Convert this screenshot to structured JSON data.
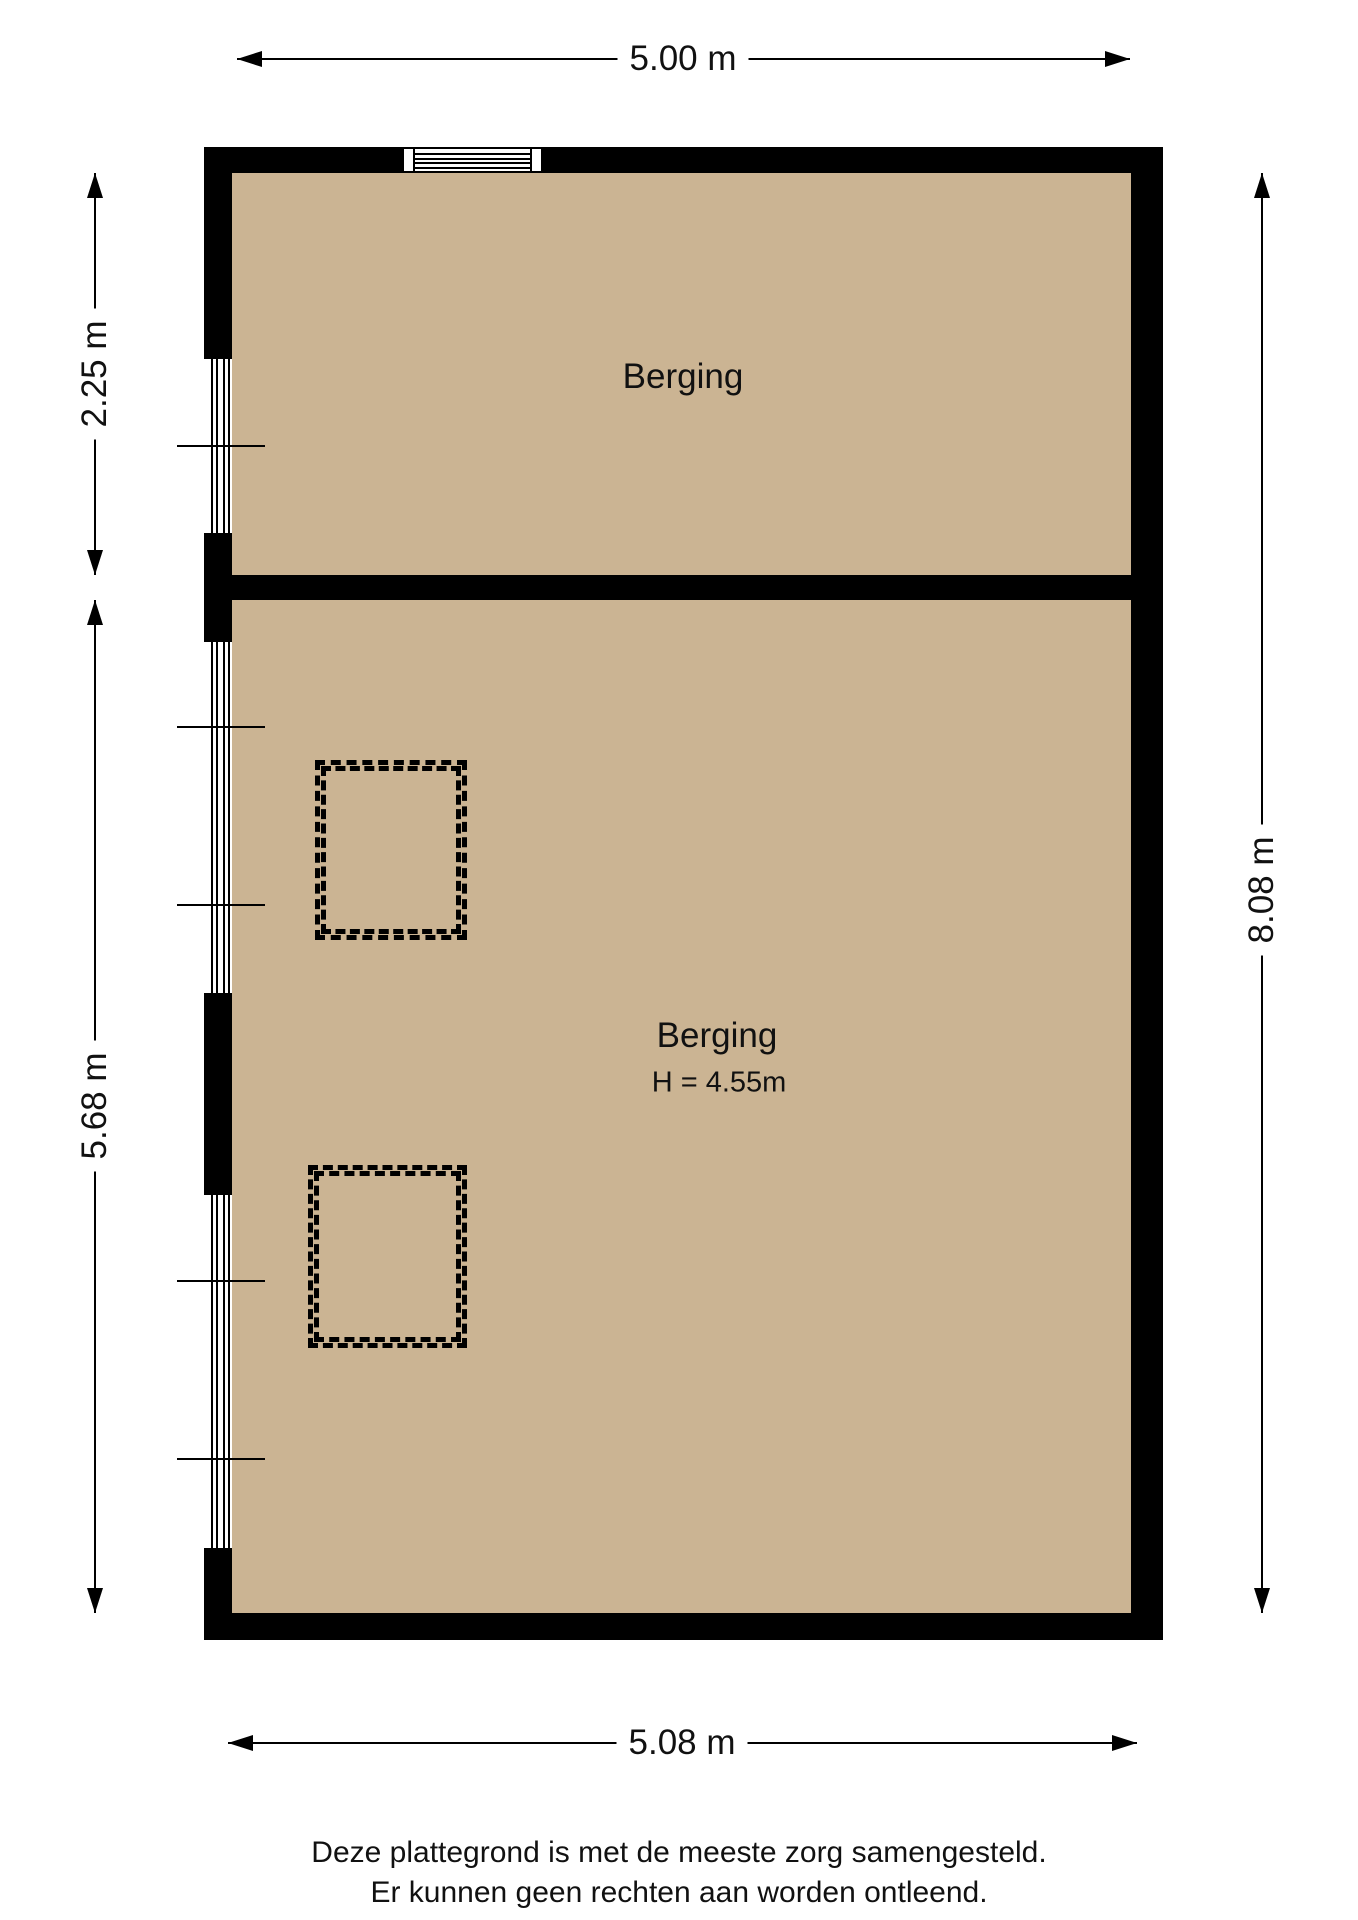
{
  "rooms": [
    {
      "label": "Berging"
    },
    {
      "label": "Berging",
      "height_label": "H = 4.55m"
    }
  ],
  "dimensions": {
    "top": "5.00 m",
    "left_top": "2.25 m",
    "left_bottom": "5.68 m",
    "right": "8.08 m",
    "bottom": "5.08 m"
  },
  "footer": {
    "line1": "Deze plattegrond is met de meeste zorg samengesteld.",
    "line2": "Er kunnen geen rechten aan worden ontleend."
  },
  "colors": {
    "floor": "#CBB493",
    "wall": "#000000",
    "dimension_line": "#000000",
    "text": "#111111"
  }
}
